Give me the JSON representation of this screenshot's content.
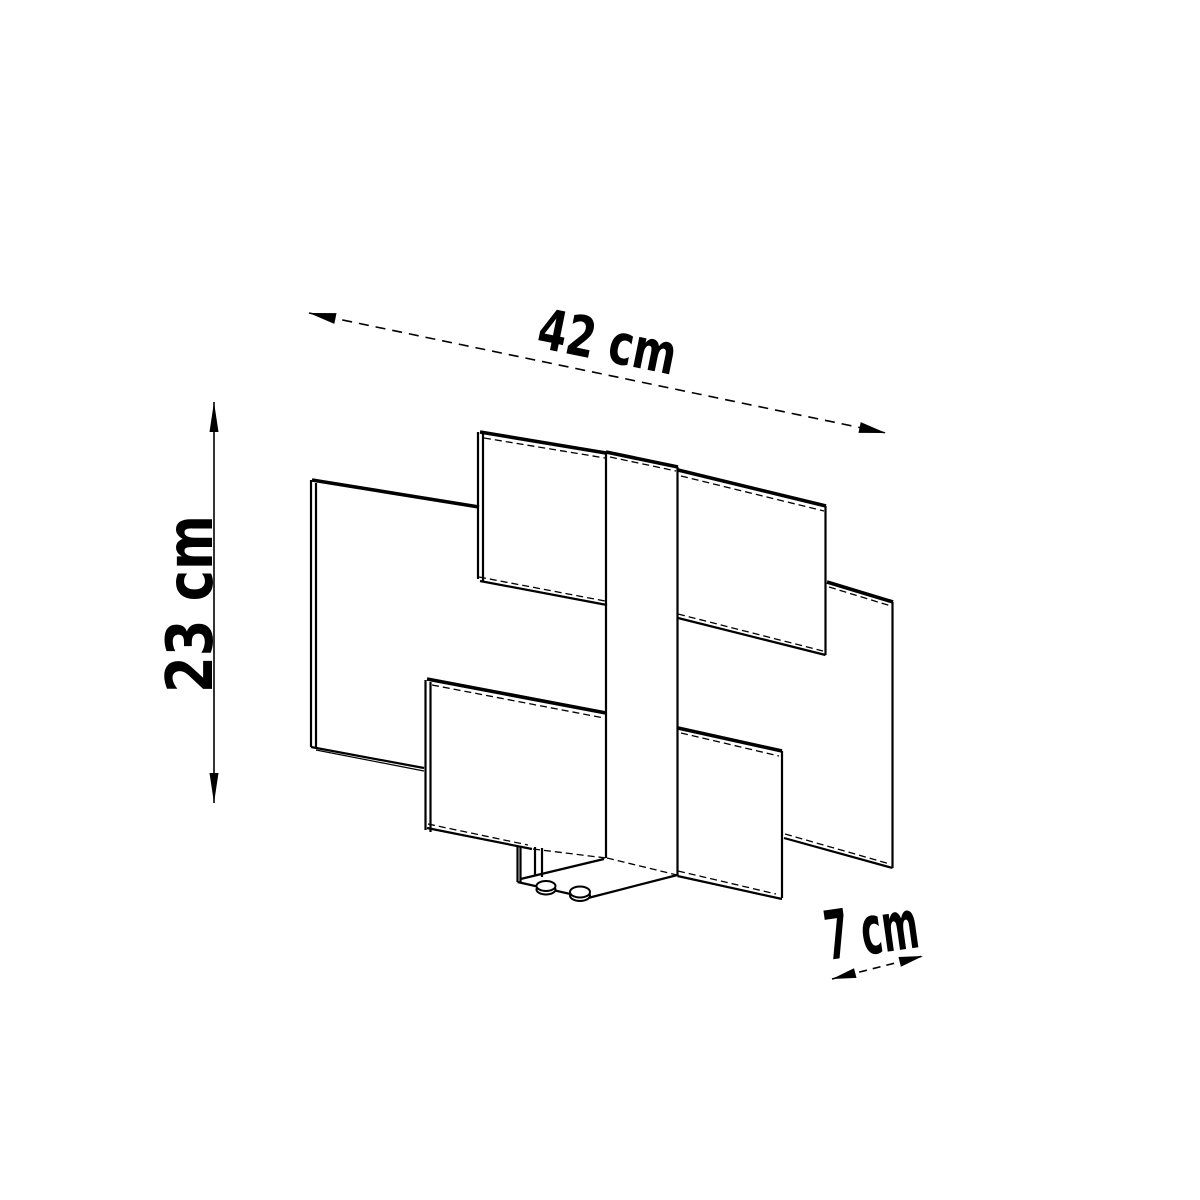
{
  "page": {
    "background": "#ffffff",
    "ink": "#000000",
    "width_px": 1200,
    "height_px": 1200
  },
  "description": "Technical dimension line drawing of a wall lamp: five offset rectangular glass panels layered around a central vertical strip with a small wall-mount bracket and two screws at the bottom",
  "dimensions": {
    "width": {
      "label": "42 cm",
      "value": 42,
      "unit": "cm"
    },
    "height": {
      "label": "23 cm",
      "value": 23,
      "unit": "cm"
    },
    "depth": {
      "label": "7 cm",
      "value": 7,
      "unit": "cm"
    }
  },
  "drawing": {
    "stroke_color": "#000000",
    "thick_edges": [
      [
        312,
        480,
        479,
        507
      ],
      [
        480,
        432,
        606,
        453
      ],
      [
        606,
        452,
        678,
        467
      ],
      [
        678,
        470,
        826,
        506
      ],
      [
        827,
        582,
        893,
        602
      ],
      [
        427,
        679,
        606,
        713
      ],
      [
        678,
        728,
        782,
        751
      ]
    ],
    "edges": [
      [
        311,
        480,
        311,
        747
      ],
      [
        316,
        483,
        316,
        749
      ],
      [
        478,
        432,
        478,
        579
      ],
      [
        483,
        434,
        483,
        581
      ],
      [
        606,
        452,
        606,
        858
      ],
      [
        677.5,
        467,
        677.5,
        875
      ],
      [
        825.5,
        506,
        825.5,
        655
      ],
      [
        892.5,
        602,
        892.5,
        868
      ],
      [
        425.5,
        680,
        425.5,
        830
      ],
      [
        430.5,
        682,
        430.5,
        832
      ],
      [
        782,
        751,
        782,
        898
      ],
      [
        311,
        747,
        424,
        768
      ],
      [
        480,
        581,
        607,
        605
      ],
      [
        678,
        618,
        825.5,
        655
      ],
      [
        784,
        838,
        892.5,
        868
      ],
      [
        427,
        828,
        532,
        849
      ],
      [
        677.5,
        876,
        782,
        899
      ],
      [
        517.5,
        846,
        517.5,
        882
      ],
      [
        520.5,
        847,
        520.5,
        882.5
      ],
      [
        535,
        847,
        535,
        876
      ],
      [
        542,
        848,
        542,
        877
      ],
      [
        517.5,
        882,
        588,
        898
      ],
      [
        588,
        898,
        677.5,
        875
      ],
      [
        520.5,
        879,
        604,
        859
      ]
    ],
    "thin_edges": [
      [
        316,
        750,
        424,
        771
      ]
    ],
    "hidden_edges": [
      [
        484,
        438,
        605,
        458
      ],
      [
        610,
        457,
        676,
        471
      ],
      [
        681,
        476,
        824,
        511
      ],
      [
        829,
        587,
        891,
        606
      ],
      [
        432,
        685,
        604,
        718
      ],
      [
        681,
        733,
        779,
        756
      ],
      [
        479,
        577,
        605,
        601
      ],
      [
        678,
        614,
        823,
        651
      ],
      [
        785,
        834,
        890,
        864
      ],
      [
        428,
        824,
        528,
        845
      ],
      [
        678,
        871,
        776,
        894
      ],
      [
        533,
        849,
        606,
        858
      ],
      [
        607,
        858,
        677,
        875
      ]
    ],
    "screws": [
      [
        546,
        889.5,
        9.5,
        5
      ],
      [
        546,
        886,
        9.5,
        5
      ],
      [
        580,
        895.5,
        10,
        5.5
      ],
      [
        580,
        892,
        10,
        5.5
      ]
    ]
  },
  "dimension_arrows": {
    "width": {
      "line": [
        309,
        313,
        886,
        433
      ],
      "dash": "10 7",
      "heads": [
        [
          309,
          313,
          334.3,
          323.9,
          336.5,
          313.1
        ],
        [
          886,
          433,
          858.5,
          432.9,
          860.7,
          422.1
        ]
      ]
    },
    "height": {
      "line": [
        214,
        402,
        214,
        803
      ],
      "dash": "",
      "heads": [
        [
          214,
          402,
          209.5,
          432,
          218.5,
          432
        ],
        [
          214,
          803,
          209.5,
          773,
          218.5,
          773
        ]
      ]
    },
    "depth": {
      "line": [
        832,
        979,
        923,
        956
      ],
      "dash": "8 6",
      "heads": [
        [
          832,
          979,
          856.5,
          977.9,
          854,
          968.3
        ],
        [
          923,
          956,
          900.9,
          966.7,
          898.5,
          957
        ]
      ]
    }
  }
}
